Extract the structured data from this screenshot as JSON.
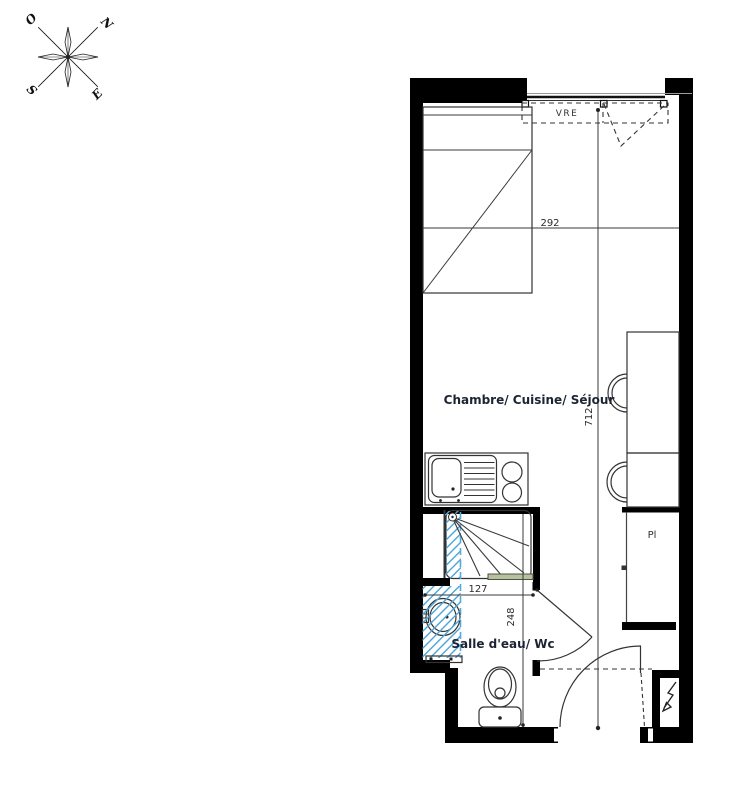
{
  "compass": {
    "o": "O",
    "n": "N",
    "s": "S",
    "e": "E"
  },
  "labels": {
    "window_shutter": "VRE",
    "main_room": "Chambre/ Cuisine/ Séjour",
    "bathroom": "Salle d'eau/ Wc",
    "closet": "Pl"
  },
  "dimensions": {
    "room_width_cm": "292",
    "room_length_cm": "712",
    "bath_width_cm": "127",
    "bath_depth_cm": "248"
  },
  "colors": {
    "wall": "#000000",
    "line": "#333333",
    "plumbing_hatch_blue": "#4da6d9",
    "shower_door_green": "#b7c19e",
    "room_label": "#1c2433"
  },
  "icons": {
    "compass": "compass-rose-icon",
    "electrical_panel": "lightning-arrow-icon"
  }
}
